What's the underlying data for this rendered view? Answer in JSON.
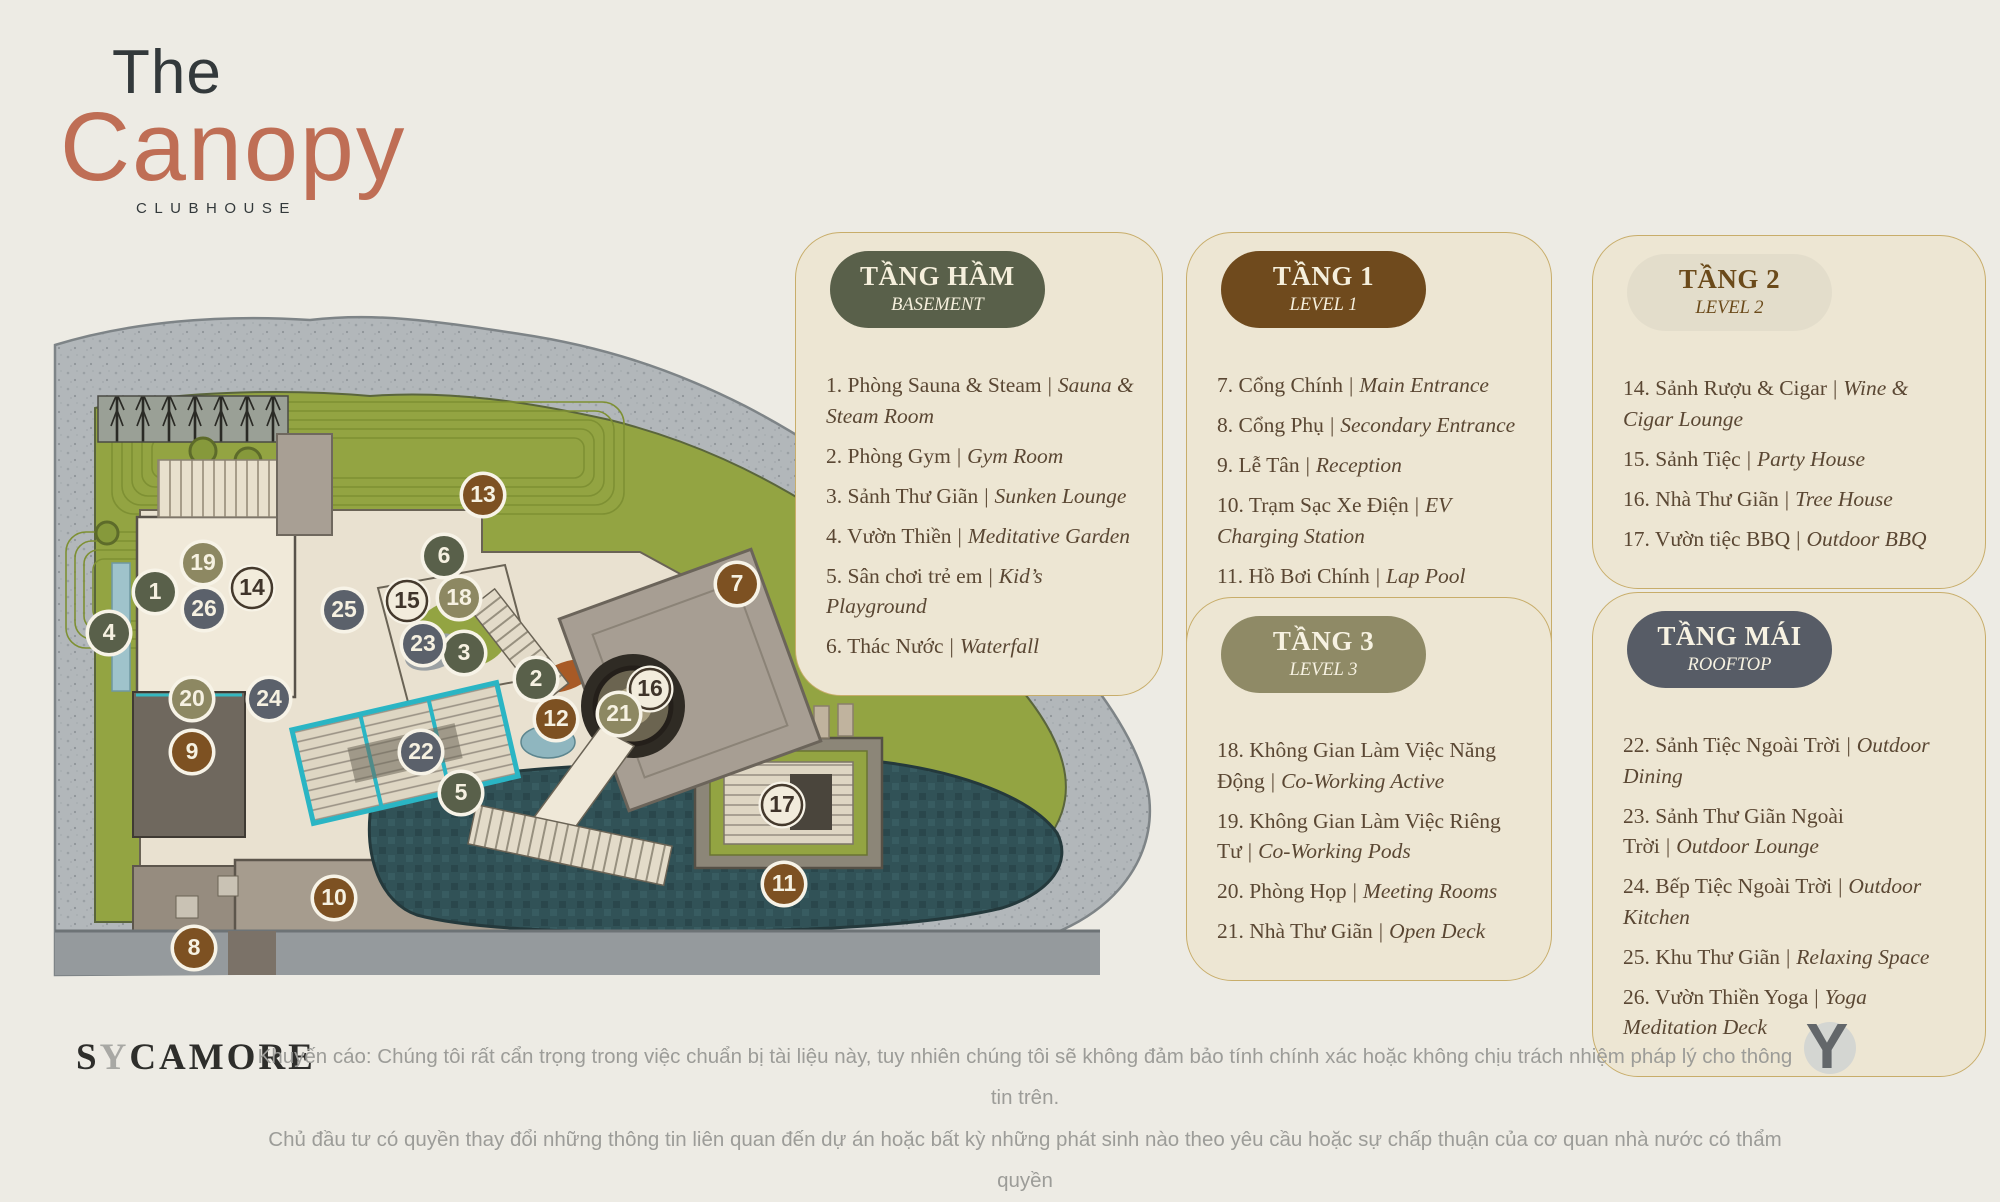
{
  "title": {
    "line1": "The",
    "line2": "Canopy",
    "line3": "CLUBHOUSE"
  },
  "legend_separator": "|",
  "levels_style": {
    "basement": {
      "pill_bg": "#59604a",
      "pill_fg": "#f5efdc",
      "marker_bg": "#59604a",
      "marker_fg": "#f6f1e1",
      "marker_border": ""
    },
    "level1": {
      "pill_bg": "#6f4a1d",
      "pill_fg": "#f5efdc",
      "marker_bg": "#7d5122",
      "marker_fg": "#f6f1e1",
      "marker_border": ""
    },
    "level2": {
      "pill_bg": "#e3ddcb",
      "pill_fg": "#6b4a1a",
      "marker_bg": "#f2ecdc",
      "marker_fg": "#3f342a",
      "marker_border": "#44392c"
    },
    "level3": {
      "pill_bg": "#8f8a66",
      "pill_fg": "#f7f2e2",
      "marker_bg": "#8d8862",
      "marker_fg": "#f6f1e1",
      "marker_border": ""
    },
    "rooftop": {
      "pill_bg": "#575c66",
      "pill_fg": "#f7f2e2",
      "marker_bg": "#5b616b",
      "marker_fg": "#f6f1e1",
      "marker_border": ""
    }
  },
  "panels": [
    {
      "id": "basement",
      "level": "basement",
      "title": "TẦNG HẦM",
      "subtitle": "BASEMENT",
      "pos": {
        "left": 795,
        "top": 232,
        "width": 368,
        "min_height": 329
      },
      "items": [
        {
          "vi": "1. Phòng Sauna & Steam",
          "en": "Sauna & Steam Room"
        },
        {
          "vi": "2. Phòng Gym",
          "en": "Gym Room"
        },
        {
          "vi": "3. Sảnh Thư Giãn",
          "en": "Sunken Lounge"
        },
        {
          "vi": "4. Vườn Thiền",
          "en": "Meditative Garden"
        },
        {
          "vi": "5. Sân chơi trẻ em",
          "en": "Kid’s Playground"
        },
        {
          "vi": "6. Thác Nước",
          "en": "Waterfall"
        }
      ]
    },
    {
      "id": "level1",
      "level": "level1",
      "title": "TẦNG 1",
      "subtitle": "LEVEL 1",
      "pos": {
        "left": 1186,
        "top": 232,
        "width": 366,
        "min_height": 344
      },
      "items": [
        {
          "vi": "7.  Cổng Chính",
          "en": "Main Entrance"
        },
        {
          "vi": "8.  Cổng Phụ",
          "en": "Secondary Entrance"
        },
        {
          "vi": "9.  Lễ Tân",
          "en": "Reception"
        },
        {
          "vi": "10. Trạm Sạc Xe Điện",
          "en": "EV Charging Station"
        },
        {
          "vi": "11. Hồ Bơi Chính",
          "en": "Lap Pool"
        },
        {
          "vi": "12. Hồ Bơi Trẻ Em",
          "en": "Kid’s Pool"
        },
        {
          "vi": "13. Hồ Tiểu Cảnh",
          "en": "Reflecting Pond"
        }
      ]
    },
    {
      "id": "level2",
      "level": "level2",
      "title": "TẦNG 2",
      "subtitle": "LEVEL 2",
      "pos": {
        "left": 1592,
        "top": 235,
        "width": 394,
        "min_height": 265
      },
      "items": [
        {
          "vi": "14. Sảnh Rượu & Cigar",
          "en": "Wine & Cigar Lounge"
        },
        {
          "vi": "15. Sảnh Tiệc",
          "en": "Party House"
        },
        {
          "vi": "16. Nhà Thư Giãn",
          "en": "Tree House"
        },
        {
          "vi": "17. Vườn tiệc BBQ",
          "en": "Outdoor BBQ"
        }
      ]
    },
    {
      "id": "level3",
      "level": "level3",
      "title": "TẦNG 3",
      "subtitle": "LEVEL 3",
      "pos": {
        "left": 1186,
        "top": 597,
        "width": 366,
        "min_height": 331
      },
      "items": [
        {
          "vi": "18. Không Gian Làm Việc Năng Động",
          "en": "Co-Working Active"
        },
        {
          "vi": "19. Không Gian Làm Việc Riêng Tư",
          "en": "Co-Working Pods"
        },
        {
          "vi": "20. Phòng Họp",
          "en": "Meeting Rooms"
        },
        {
          "vi": "21. Nhà Thư Giãn",
          "en": "Open Deck"
        }
      ]
    },
    {
      "id": "rooftop",
      "level": "rooftop",
      "title": "TẦNG MÁI",
      "subtitle": "ROOFTOP",
      "pos": {
        "left": 1592,
        "top": 592,
        "width": 394,
        "min_height": 278
      },
      "items": [
        {
          "vi": "22. Sảnh Tiệc Ngoài Trời",
          "en": "Outdoor Dining"
        },
        {
          "vi": "23. Sảnh Thư Giãn Ngoài Trời",
          "en": "Outdoor Lounge"
        },
        {
          "vi": "24. Bếp Tiệc Ngoài Trời",
          "en": "Outdoor Kitchen"
        },
        {
          "vi": "25. Khu Thư Giãn",
          "en": "Relaxing Space"
        },
        {
          "vi": "26. Vườn Thiền Yoga",
          "en": "Yoga Meditation Deck"
        }
      ]
    }
  ],
  "map": {
    "marker_ring": "#f7f3e7",
    "markers": [
      {
        "n": 1,
        "level": "basement",
        "x": 155,
        "y": 592
      },
      {
        "n": 2,
        "level": "basement",
        "x": 536,
        "y": 679
      },
      {
        "n": 3,
        "level": "basement",
        "x": 464,
        "y": 653
      },
      {
        "n": 4,
        "level": "basement",
        "x": 109,
        "y": 633
      },
      {
        "n": 5,
        "level": "basement",
        "x": 461,
        "y": 793
      },
      {
        "n": 6,
        "level": "basement",
        "x": 444,
        "y": 556
      },
      {
        "n": 7,
        "level": "level1",
        "x": 737,
        "y": 584
      },
      {
        "n": 8,
        "level": "level1",
        "x": 194,
        "y": 948
      },
      {
        "n": 9,
        "level": "level1",
        "x": 192,
        "y": 752
      },
      {
        "n": 10,
        "level": "level1",
        "x": 334,
        "y": 898
      },
      {
        "n": 11,
        "level": "level1",
        "x": 784,
        "y": 884
      },
      {
        "n": 12,
        "level": "level1",
        "x": 556,
        "y": 719
      },
      {
        "n": 13,
        "level": "level1",
        "x": 483,
        "y": 495
      },
      {
        "n": 14,
        "level": "level2",
        "x": 252,
        "y": 588
      },
      {
        "n": 15,
        "level": "level2",
        "x": 407,
        "y": 601
      },
      {
        "n": 16,
        "level": "level2",
        "x": 650,
        "y": 689
      },
      {
        "n": 17,
        "level": "level2",
        "x": 782,
        "y": 805
      },
      {
        "n": 18,
        "level": "level3",
        "x": 459,
        "y": 598
      },
      {
        "n": 19,
        "level": "level3",
        "x": 203,
        "y": 563
      },
      {
        "n": 20,
        "level": "level3",
        "x": 192,
        "y": 699
      },
      {
        "n": 21,
        "level": "level3",
        "x": 619,
        "y": 714
      },
      {
        "n": 22,
        "level": "rooftop",
        "x": 421,
        "y": 752
      },
      {
        "n": 23,
        "level": "rooftop",
        "x": 423,
        "y": 644
      },
      {
        "n": 24,
        "level": "rooftop",
        "x": 269,
        "y": 699
      },
      {
        "n": 25,
        "level": "rooftop",
        "x": 344,
        "y": 610
      },
      {
        "n": 26,
        "level": "rooftop",
        "x": 204,
        "y": 609
      }
    ]
  },
  "footer": {
    "brand_pre": "S",
    "brand_y": "Y",
    "brand_post": "CAMORE",
    "disclaimer_line1": "Khuyến cáo: Chúng tôi rất cẩn trọng trong việc chuẩn bị tài liệu này, tuy nhiên chúng tôi sẽ không đảm bảo tính chính xác hoặc không chịu trách nhiệm pháp lý cho thông tin trên.",
    "disclaimer_line2": "Chủ đầu tư có quyền thay đổi những thông tin liên quan đến dự án hoặc bất kỳ những phát sinh nào theo yêu cầu hoặc sự chấp thuận của cơ quan nhà nước có thẩm quyền",
    "logo_mark": "Y"
  },
  "colors": {
    "page_bg": "#edebe4",
    "panel_bg": "#ede6d3",
    "panel_border": "#c8ad6a",
    "accent_terracotta": "#bf6e55",
    "title_dark": "#33393b",
    "list_text": "#5a4733",
    "disclaimer_text": "#9c9c98",
    "pool": "#315257",
    "lawn": "#93a442",
    "stone": "#b2b7ba"
  }
}
